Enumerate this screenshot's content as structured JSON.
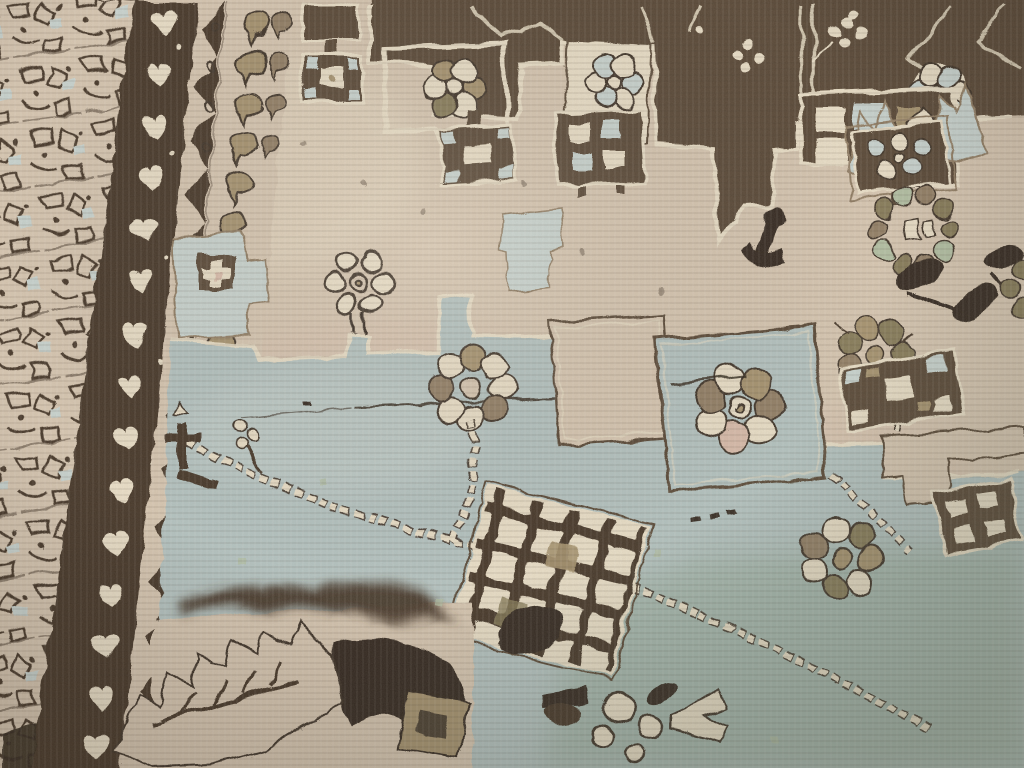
{
  "image": {
    "type": "photograph",
    "title": "Antique hand-knotted carpet — close-up detail",
    "alt": "Oblique close-up photograph of a worn antique hand-knotted wool rug. A cream field carries dark brown stepped medallion outlines and rosette flowers; a large pale blue-grey medallion area with beaded floral vines, checkerboard diamonds and rosette clusters fills the lower center; ornate borders run down the left side: a floral lattice border, a dark brown band of cream trefoils, a zigzag guard stripe and a cream band with a column of small boteh motifs."
  },
  "palette": {
    "cream": "#d7c7b2",
    "creamLight": "#eadfc8",
    "pink": "#d9bcab",
    "brown": "#5a4a37",
    "brownDark": "#46382a",
    "brownDeep": "#352b20",
    "taupe": "#927f66",
    "khaki": "#a6936f",
    "olive": "#877c5a",
    "green": "#b2bfa3",
    "blue": "#b4c3c1",
    "bluePale": "#c9d4d0",
    "blueGreen": "#9cb0a2",
    "outline": "#40342a"
  },
  "motifs": [
    "floral lattice border",
    "reciprocal trefoil guard band",
    "zigzag guard stripe",
    "boteh column band",
    "stepped medallion outline",
    "rosette flower",
    "checkerboard diamond",
    "beaded floral vine",
    "rosette wreath pendant",
    "serrated leaf",
    "palmette leaves"
  ]
}
